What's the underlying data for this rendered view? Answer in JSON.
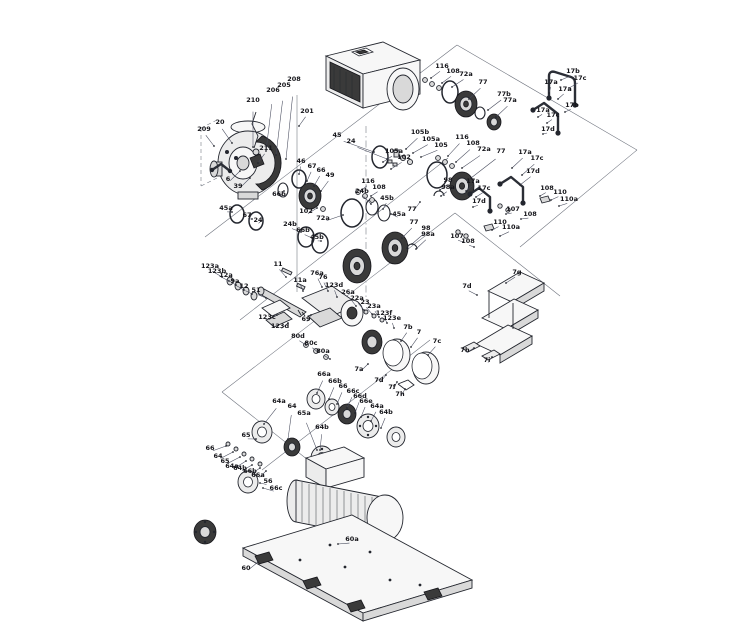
{
  "diagram": {
    "type": "exploded-parts-diagram",
    "subject": "pump-assembly-exploded-view",
    "colors": {
      "background": "#ffffff",
      "line": "#23262e",
      "label": "#15151a",
      "fill_light": "#ececec",
      "fill_dark": "#3a3a3a"
    },
    "callouts": [
      [
        "209",
        204,
        131,
        214,
        146
      ],
      [
        "20",
        220,
        124,
        232,
        143
      ],
      [
        "210",
        253,
        102,
        253,
        147
      ],
      [
        "206",
        273,
        92,
        266,
        151
      ],
      [
        "205",
        284,
        87,
        276,
        155
      ],
      [
        "208",
        294,
        81,
        286,
        159
      ],
      [
        "201",
        307,
        113,
        299,
        126
      ],
      [
        "211",
        266,
        150,
        258,
        163
      ],
      [
        "6",
        228,
        181,
        240,
        171
      ],
      [
        "39",
        238,
        188,
        250,
        178
      ],
      [
        "45",
        337,
        137,
        374,
        152
      ],
      [
        "24",
        351,
        143,
        387,
        159
      ],
      [
        "46",
        301,
        163,
        299,
        174
      ],
      [
        "67",
        312,
        168,
        307,
        181
      ],
      [
        "66",
        321,
        172,
        314,
        186
      ],
      [
        "49",
        330,
        177,
        321,
        191
      ],
      [
        "66b",
        279,
        196,
        284,
        191
      ],
      [
        "45a",
        226,
        210,
        232,
        212
      ],
      [
        "67",
        247,
        217,
        252,
        219
      ],
      [
        "24",
        258,
        222,
        261,
        221
      ],
      [
        "102",
        306,
        213,
        317,
        208
      ],
      [
        "72a",
        323,
        220,
        343,
        215
      ],
      [
        "24b",
        290,
        226,
        301,
        232
      ],
      [
        "66b",
        303,
        232,
        312,
        238
      ],
      [
        "45b",
        317,
        239,
        321,
        241
      ],
      [
        "116",
        368,
        183,
        362,
        190
      ],
      [
        "108",
        379,
        189,
        371,
        196
      ],
      [
        "24b",
        362,
        193,
        371,
        204
      ],
      [
        "45b",
        387,
        200,
        383,
        209
      ],
      [
        "45a",
        399,
        216,
        391,
        214
      ],
      [
        "116",
        442,
        68,
        431,
        78
      ],
      [
        "108",
        453,
        73,
        442,
        83
      ],
      [
        "72a",
        466,
        76,
        452,
        87
      ],
      [
        "77",
        483,
        84,
        469,
        99
      ],
      [
        "77b",
        504,
        96,
        488,
        110
      ],
      [
        "77a",
        510,
        102,
        496,
        117
      ],
      [
        "17b",
        573,
        73,
        561,
        80
      ],
      [
        "17c",
        580,
        80,
        569,
        88
      ],
      [
        "17a",
        551,
        84,
        549,
        93
      ],
      [
        "17a",
        565,
        91,
        558,
        99
      ],
      [
        "17b",
        572,
        107,
        565,
        112
      ],
      [
        "17a",
        543,
        112,
        538,
        117
      ],
      [
        "17c",
        553,
        117,
        547,
        123
      ],
      [
        "17d",
        548,
        131,
        543,
        134
      ],
      [
        "105b",
        420,
        134,
        406,
        149
      ],
      [
        "105a",
        431,
        141,
        413,
        153
      ],
      [
        "105",
        441,
        147,
        421,
        157
      ],
      [
        "116",
        462,
        139,
        448,
        156
      ],
      [
        "108",
        473,
        145,
        456,
        162
      ],
      [
        "72a",
        484,
        151,
        462,
        168
      ],
      [
        "77",
        501,
        153,
        471,
        178
      ],
      [
        "17a",
        525,
        154,
        512,
        168
      ],
      [
        "17c",
        537,
        160,
        522,
        175
      ],
      [
        "17d",
        533,
        173,
        520,
        185
      ],
      [
        "105a",
        394,
        153,
        383,
        162
      ],
      [
        "102",
        404,
        159,
        391,
        169
      ],
      [
        "77",
        412,
        211,
        420,
        202
      ],
      [
        "98",
        448,
        182,
        440,
        190
      ],
      [
        "98a",
        448,
        189,
        441,
        196
      ],
      [
        "17a",
        473,
        183,
        466,
        191
      ],
      [
        "17c",
        484,
        190,
        476,
        197
      ],
      [
        "17d",
        479,
        203,
        473,
        207
      ],
      [
        "107",
        513,
        211,
        506,
        214
      ],
      [
        "108",
        530,
        216,
        521,
        219
      ],
      [
        "77",
        414,
        224,
        402,
        238
      ],
      [
        "98",
        426,
        230,
        412,
        244
      ],
      [
        "98a",
        428,
        236,
        416,
        249
      ],
      [
        "107",
        457,
        238,
        463,
        242
      ],
      [
        "108",
        468,
        243,
        474,
        247
      ],
      [
        "110",
        500,
        224,
        492,
        230
      ],
      [
        "110a",
        511,
        229,
        500,
        236
      ],
      [
        "108",
        547,
        190,
        540,
        196
      ],
      [
        "110",
        560,
        194,
        551,
        200
      ],
      [
        "110a",
        569,
        201,
        559,
        206
      ],
      [
        "123a",
        210,
        268,
        222,
        277
      ],
      [
        "123b",
        217,
        273,
        229,
        281
      ],
      [
        "12a",
        226,
        277,
        236,
        285
      ],
      [
        "9a",
        235,
        283,
        244,
        290
      ],
      [
        "12",
        244,
        288,
        252,
        294
      ],
      [
        "51",
        256,
        292,
        266,
        298
      ],
      [
        "11",
        278,
        266,
        286,
        277
      ],
      [
        "11a",
        300,
        282,
        303,
        291
      ],
      [
        "76a",
        317,
        275,
        322,
        287
      ],
      [
        "76",
        323,
        279,
        328,
        291
      ],
      [
        "123d",
        334,
        287,
        337,
        297
      ],
      [
        "26a",
        348,
        294,
        356,
        306
      ],
      [
        "22a",
        357,
        300,
        364,
        310
      ],
      [
        "23",
        365,
        304,
        372,
        314
      ],
      [
        "23a",
        374,
        308,
        379,
        317
      ],
      [
        "123f",
        384,
        315,
        387,
        323
      ],
      [
        "123e",
        392,
        320,
        394,
        328
      ],
      [
        "123c",
        267,
        319,
        277,
        315
      ],
      [
        "123d",
        280,
        328,
        288,
        323
      ],
      [
        "69",
        306,
        321,
        311,
        315
      ],
      [
        "80d",
        298,
        338,
        306,
        345
      ],
      [
        "80c",
        311,
        345,
        318,
        352
      ],
      [
        "80a",
        323,
        353,
        330,
        359
      ],
      [
        "7b",
        408,
        329,
        401,
        341
      ],
      [
        "7",
        419,
        334,
        411,
        347
      ],
      [
        "7c",
        437,
        343,
        428,
        355
      ],
      [
        "7a",
        359,
        371,
        368,
        364
      ],
      [
        "7d",
        379,
        382,
        386,
        375
      ],
      [
        "7f",
        392,
        389,
        397,
        382
      ],
      [
        "7h",
        400,
        396,
        405,
        389
      ],
      [
        "7g",
        517,
        274,
        506,
        283
      ],
      [
        "7d",
        467,
        288,
        477,
        295
      ],
      [
        "7h",
        465,
        352,
        474,
        348
      ],
      [
        "7i",
        487,
        362,
        492,
        357
      ],
      [
        "66a",
        324,
        376,
        317,
        393
      ],
      [
        "66b",
        335,
        383,
        329,
        399
      ],
      [
        "66",
        343,
        388,
        337,
        404
      ],
      [
        "66c",
        353,
        393,
        347,
        408
      ],
      [
        "66d",
        360,
        398,
        355,
        413
      ],
      [
        "66e",
        366,
        403,
        361,
        417
      ],
      [
        "64a",
        377,
        408,
        371,
        421
      ],
      [
        "64b",
        386,
        414,
        381,
        428
      ],
      [
        "64a",
        279,
        403,
        264,
        424
      ],
      [
        "64",
        292,
        408,
        288,
        439
      ],
      [
        "65a",
        304,
        415,
        317,
        450
      ],
      [
        "64b",
        322,
        429,
        320,
        450
      ],
      [
        "65",
        246,
        437,
        256,
        439
      ],
      [
        "66",
        210,
        450,
        226,
        446
      ],
      [
        "64",
        218,
        458,
        233,
        452
      ],
      [
        "65",
        225,
        463,
        240,
        457
      ],
      [
        "64a",
        232,
        468,
        246,
        461
      ],
      [
        "64b",
        240,
        470,
        252,
        465
      ],
      [
        "66b",
        250,
        473,
        260,
        468
      ],
      [
        "66a",
        258,
        477,
        266,
        471
      ],
      [
        "56",
        268,
        483,
        260,
        483
      ],
      [
        "66c",
        276,
        490,
        263,
        488
      ],
      [
        "60a",
        352,
        541,
        338,
        544
      ],
      [
        "60",
        246,
        570,
        258,
        562
      ]
    ]
  }
}
